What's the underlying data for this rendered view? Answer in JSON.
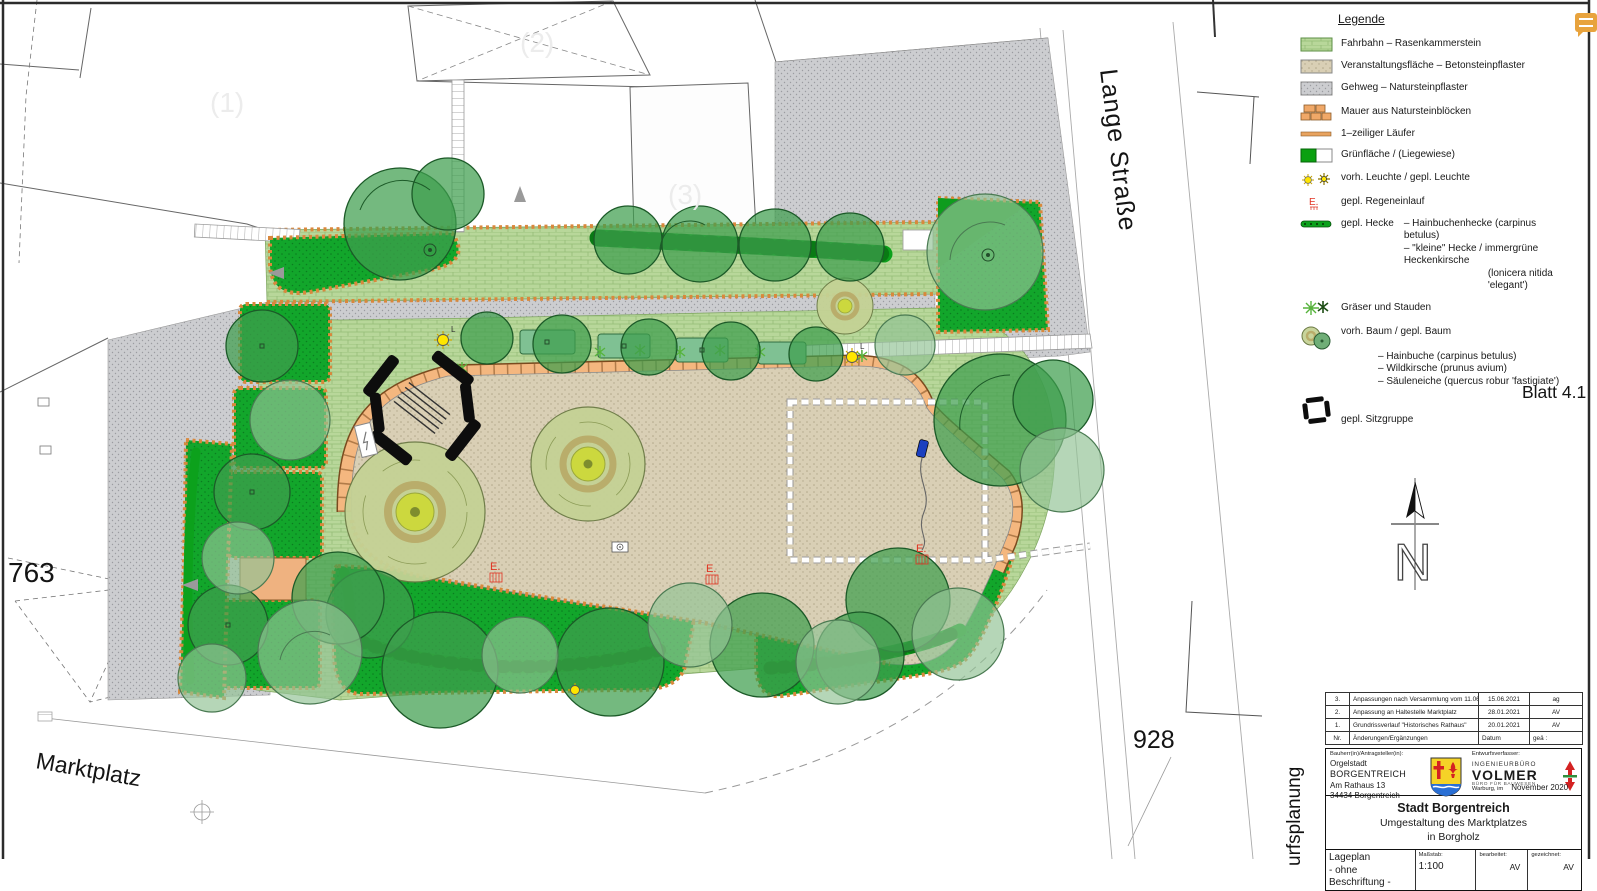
{
  "colors": {
    "road_green": "#b8d79a",
    "lawn_green": "#12a62b",
    "plaza_tan": "#d9cfb5",
    "sidewalk_gray": "#cccdd0",
    "wall_orange": "#f4b77f",
    "hedge_green": "#0ca11c",
    "tree_green": "#3f9e4e",
    "tree_light": "#92c295",
    "accent_red": "#e03322",
    "lamp_yellow": "#ffe600",
    "comment_orange": "#e8a33d"
  },
  "plan": {
    "labels": {
      "parcel_left": "763",
      "parcel_right": "928",
      "square": "Marktplatz",
      "street": "Lange Straße",
      "sheet_no": "Blatt 4.1",
      "north": "N",
      "faint_1": "(1)",
      "faint_2": "(2)",
      "faint_3": "(3)",
      "drain": "E.",
      "lamp": "L"
    }
  },
  "legend": {
    "title": "Legende",
    "items": [
      {
        "icon": "road-swatch",
        "label": "Fahrbahn  –  Rasenkammerstein"
      },
      {
        "icon": "event-swatch",
        "label": "Veranstaltungsfläche  –  Betonsteinpflaster"
      },
      {
        "icon": "walk-swatch",
        "label": "Gehweg  –  Natursteinpflaster"
      },
      {
        "icon": "wall-blocks",
        "label": "Mauer aus Natursteinblöcken"
      },
      {
        "icon": "runner-line",
        "label": "1–zeiliger Läufer"
      },
      {
        "icon": "green-swatch",
        "label": "Grünfläche  /  (Liegewiese)"
      },
      {
        "icon": "lamp-stars",
        "label": "vorh. Leuchte  /  gepl. Leuchte"
      },
      {
        "icon": "drain-mark",
        "label": "gepl. Regeneinlauf"
      }
    ],
    "hedge": {
      "label": "gepl. Hecke",
      "line1": "–  Hainbuchenhecke  (carpinus betulus)",
      "line2": "–  \"kleine\"  Hecke  /  immergrüne  Heckenkirsche",
      "line3": "(lonicera nitida 'elegant')"
    },
    "grasses": {
      "label": "Gräser und Stauden"
    },
    "trees": {
      "label": "vorh. Baum  /  gepl. Baum",
      "line1": "–  Hainbuche  (carpinus betulus)",
      "line2": "–  Wildkirsche  (prunus avium)",
      "line3": "–  Säuleneiche  (quercus robur 'fastigiate')"
    },
    "seating": {
      "label": "gepl. Sitzgruppe"
    }
  },
  "titleblock": {
    "revisions": {
      "rows": [
        {
          "nr": "3.",
          "text": "Anpassungen nach Versammlung vom 11.06.2021",
          "date": "15.06.2021",
          "by": "ag"
        },
        {
          "nr": "2.",
          "text": "Anpassung an Haltestelle Marktplatz",
          "date": "28.01.2021",
          "by": "AV"
        },
        {
          "nr": "1.",
          "text": "Grundrissverlauf \"Historisches Rathaus\"",
          "date": "20.01.2021",
          "by": "AV"
        }
      ],
      "header": {
        "nr": "Nr.",
        "text": "Änderungen/Ergänzungen",
        "date": "Datum",
        "by": "geä :"
      }
    },
    "client_label": "Bauherr(in)/Antragsteller(in):",
    "client_line1": "Orgelstadt",
    "client_line2": "BORGENTREICH",
    "client_line3": "Am Rathaus 13",
    "client_line4": "34434 Borgentreich",
    "designer_label": "Entwurfsverfasser:",
    "designer_small": "INGENIEURBÜRO",
    "designer_name": "VOLMER",
    "designer_sub": "BÜRO FÜR BAUWESEN",
    "place": "Warburg, im",
    "date": "November 2020",
    "project_line1": "Stadt Borgentreich",
    "project_line2": "Umgestaltung des Marktplatzes",
    "project_line3": "in Borgholz",
    "doc_title": "Lageplan",
    "doc_sub": "- ohne Beschriftung -",
    "scale_label": "Maßstab:",
    "scale": "1:100",
    "edited_label": "bearbeitet:",
    "edited": "AV",
    "drawn_label": "gezeichnet:",
    "drawn": "AV",
    "side_text": "urfsplanung"
  }
}
